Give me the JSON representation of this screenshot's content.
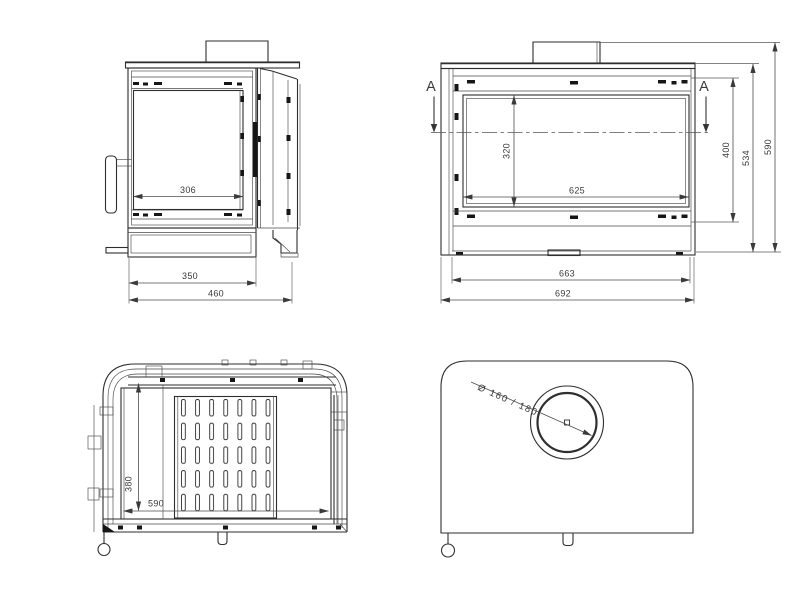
{
  "colors": {
    "background": "#ffffff",
    "line": "#2e2e2e",
    "dimension_line": "#4d4d4d",
    "text": "#3a3a3a"
  },
  "views": {
    "side": {
      "dims": {
        "glass_depth": "306",
        "body_depth": "350",
        "overall_depth": "460"
      }
    },
    "front": {
      "section_marker": "A",
      "dims": {
        "glass_height": "320",
        "glass_width": "625",
        "frame_height": "400",
        "body_height": "534",
        "overall_height": "590",
        "body_width": "663",
        "overall_width": "692"
      }
    },
    "section": {
      "dims": {
        "firebox_depth": "380",
        "firebox_width": "590"
      }
    },
    "top": {
      "dims": {
        "flue_diameter": "Ø 160 / 180"
      }
    }
  }
}
